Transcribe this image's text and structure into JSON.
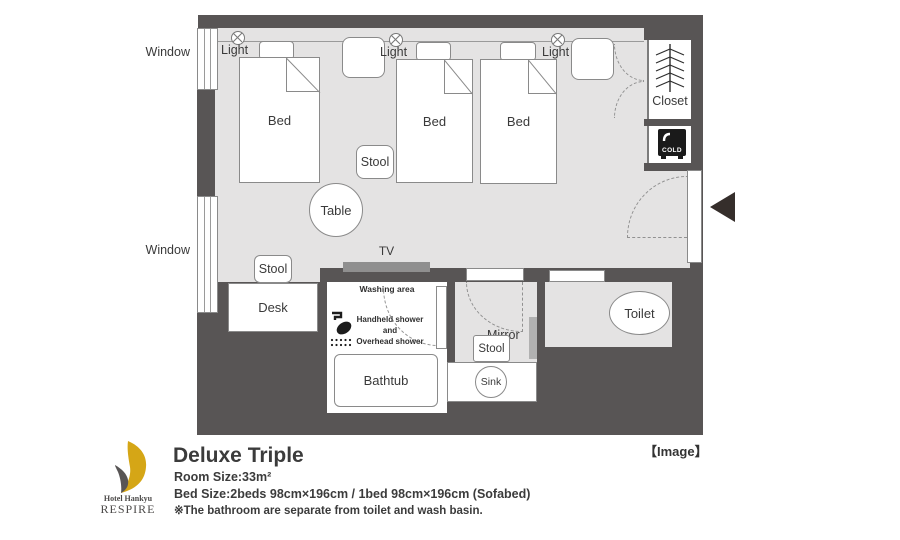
{
  "colors": {
    "wall": "#585555",
    "floor": "#e4e3e3",
    "accent_gold": "#d5a616",
    "logo_gray": "#585555",
    "fridge_black": "#1a1a1a",
    "arrow_black": "#352e2b"
  },
  "plan": {
    "windows": [
      {
        "label": "Window"
      },
      {
        "label": "Window"
      }
    ],
    "lights": [
      {
        "label": "Light"
      },
      {
        "label": "Light"
      },
      {
        "label": "Light"
      }
    ],
    "beds": [
      {
        "label": "Bed"
      },
      {
        "label": "Bed"
      },
      {
        "label": "Bed"
      }
    ],
    "table_label": "Table",
    "stool_center_label": "Stool",
    "stool_desk_label": "Stool",
    "desk_label": "Desk",
    "tv_label": "TV",
    "closet_label": "Closet",
    "fridge_label": "COLD",
    "washing_area": {
      "title": "Washing area",
      "line1": "Handheld shower",
      "line2": "and",
      "line3": "Overhead shower",
      "bathtub_label": "Bathtub"
    },
    "bath_annex": {
      "mirror_label": "Mirror",
      "stool_label": "Stool",
      "sink_label": "Sink",
      "toilet_label": "Toilet"
    },
    "image_tag": "【Image】"
  },
  "footer": {
    "logo_name": "Hotel Hankyu",
    "logo_brand": "RESPIRE",
    "title": "Deluxe Triple",
    "room_size": "Room Size:33m²",
    "bed_size": "Bed Size:2beds 98cm×196cm / 1bed 98cm×196cm (Sofabed)",
    "note": "※The bathroom are separate from toilet and wash basin."
  }
}
